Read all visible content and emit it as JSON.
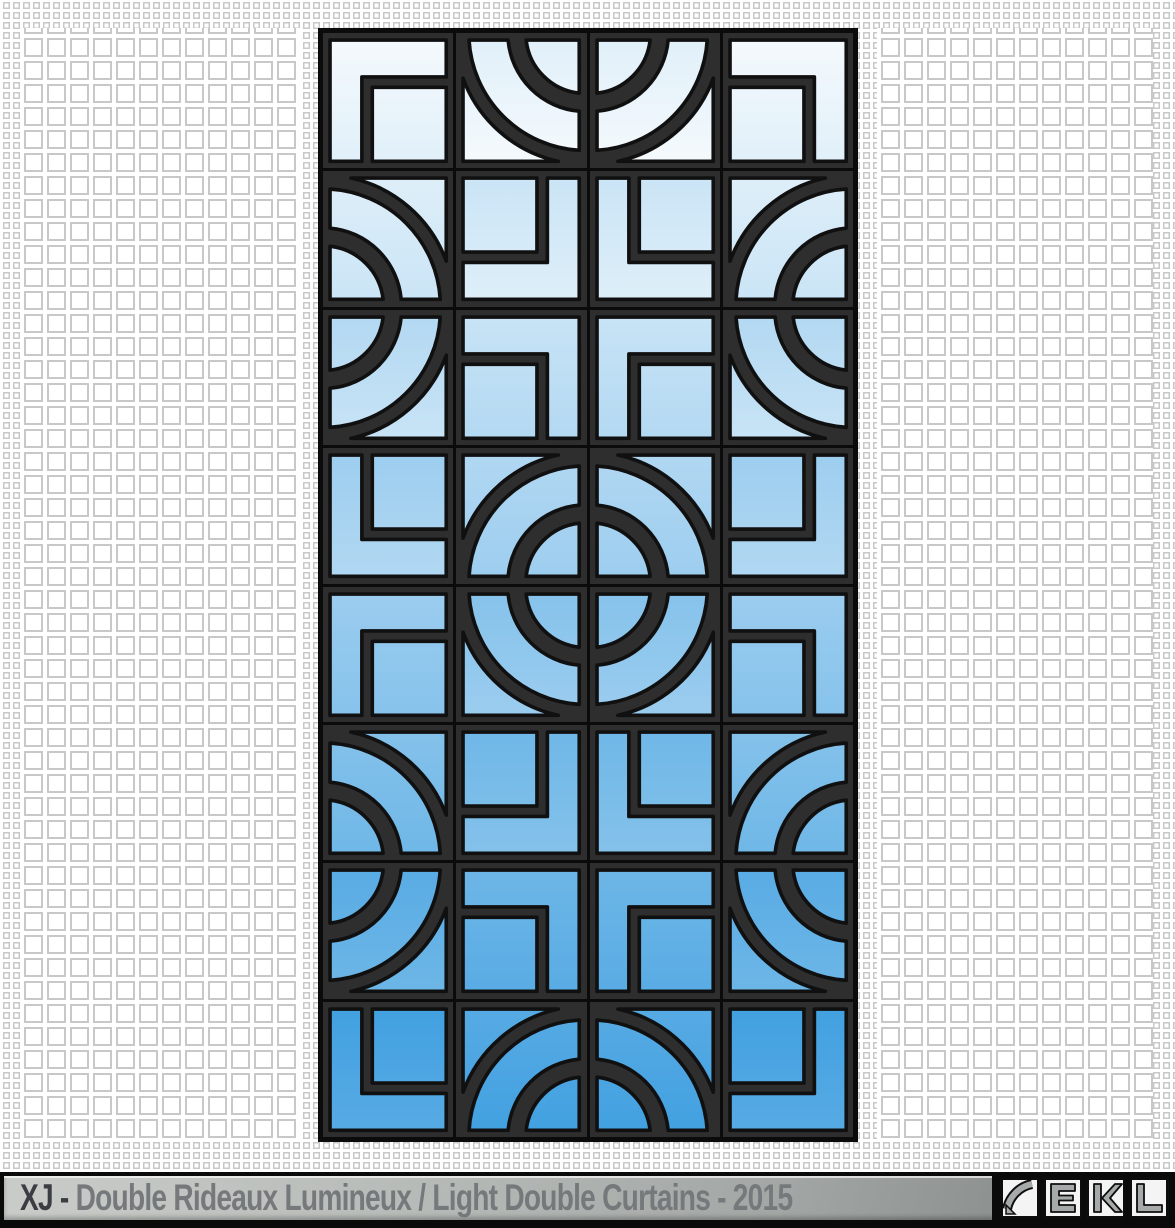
{
  "page": {
    "width": 1175,
    "height": 1228,
    "background": "#ffffff"
  },
  "background_pattern": {
    "type": "outlined-square-grid",
    "line_color": "#c8c8c8",
    "small_cell_px": 10,
    "large_cell_px": 23
  },
  "panel": {
    "columns": 4,
    "rows": 8,
    "frame_color": "#0b0b0b",
    "grout_color": "#2e2e2e",
    "stroke_color": "#101010",
    "gradient_top": "#f6fafd",
    "gradient_bottom": "#41a0e0",
    "tiles": [
      [
        "corner-br",
        "arcs-tr",
        "arcs-tl",
        "corner-bl"
      ],
      [
        "arcs-bl",
        "corner-tl",
        "corner-tr",
        "arcs-br"
      ],
      [
        "arcs-tl",
        "corner-bl",
        "corner-br",
        "arcs-tr"
      ],
      [
        "corner-tr",
        "arcs-br",
        "arcs-bl",
        "corner-tl"
      ],
      [
        "corner-br",
        "arcs-tr",
        "arcs-tl",
        "corner-bl"
      ],
      [
        "arcs-bl",
        "corner-tl",
        "corner-tr",
        "arcs-br"
      ],
      [
        "arcs-tl",
        "corner-bl",
        "corner-br",
        "arcs-tr"
      ],
      [
        "corner-tr",
        "arcs-br",
        "arcs-bl",
        "corner-tl"
      ]
    ]
  },
  "footer": {
    "title_prefix": "XJ - ",
    "title_rest": "Double Rideaux Lumineux / Light Double Curtains - 2015",
    "prefix_color": "#3a3e42",
    "text_color": "#75797b",
    "bar_gradient": [
      "#c9ccc9",
      "#b8bcb9",
      "#a2a6a4",
      "#7c807e"
    ],
    "logo": {
      "mark": "arc-glyph",
      "letters": [
        "E",
        "K",
        "L"
      ],
      "letter_color": "#a7aaaa",
      "box_color": "#f4f4f4"
    }
  }
}
